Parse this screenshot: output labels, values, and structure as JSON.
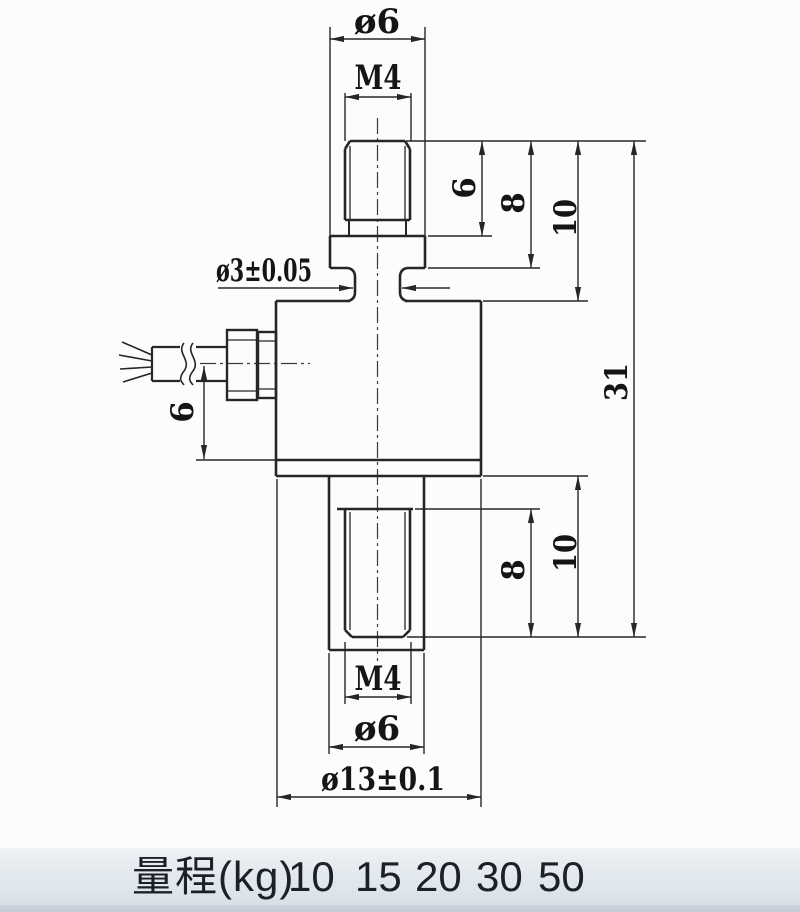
{
  "drawing": {
    "title": "miniature load cell dimension drawing",
    "line_color": "#262626",
    "labels": {
      "dia6_top": "ø6",
      "m4_top": "M4",
      "dia3_neck": "ø3±0.05",
      "len6_top": "6",
      "len8_top": "8",
      "len10_top": "10",
      "len31_overall": "31",
      "len6_cable": "6",
      "len8_bottom": "8",
      "len10_bottom": "10",
      "m4_bottom": "M4",
      "dia6_bottom": "ø6",
      "dia13_body": "ø13±0.1"
    }
  },
  "range_table": {
    "label": "量程(kg)",
    "values": [
      "10",
      "15",
      "20",
      "30",
      "50"
    ],
    "band_color": "#dfe6ec"
  }
}
